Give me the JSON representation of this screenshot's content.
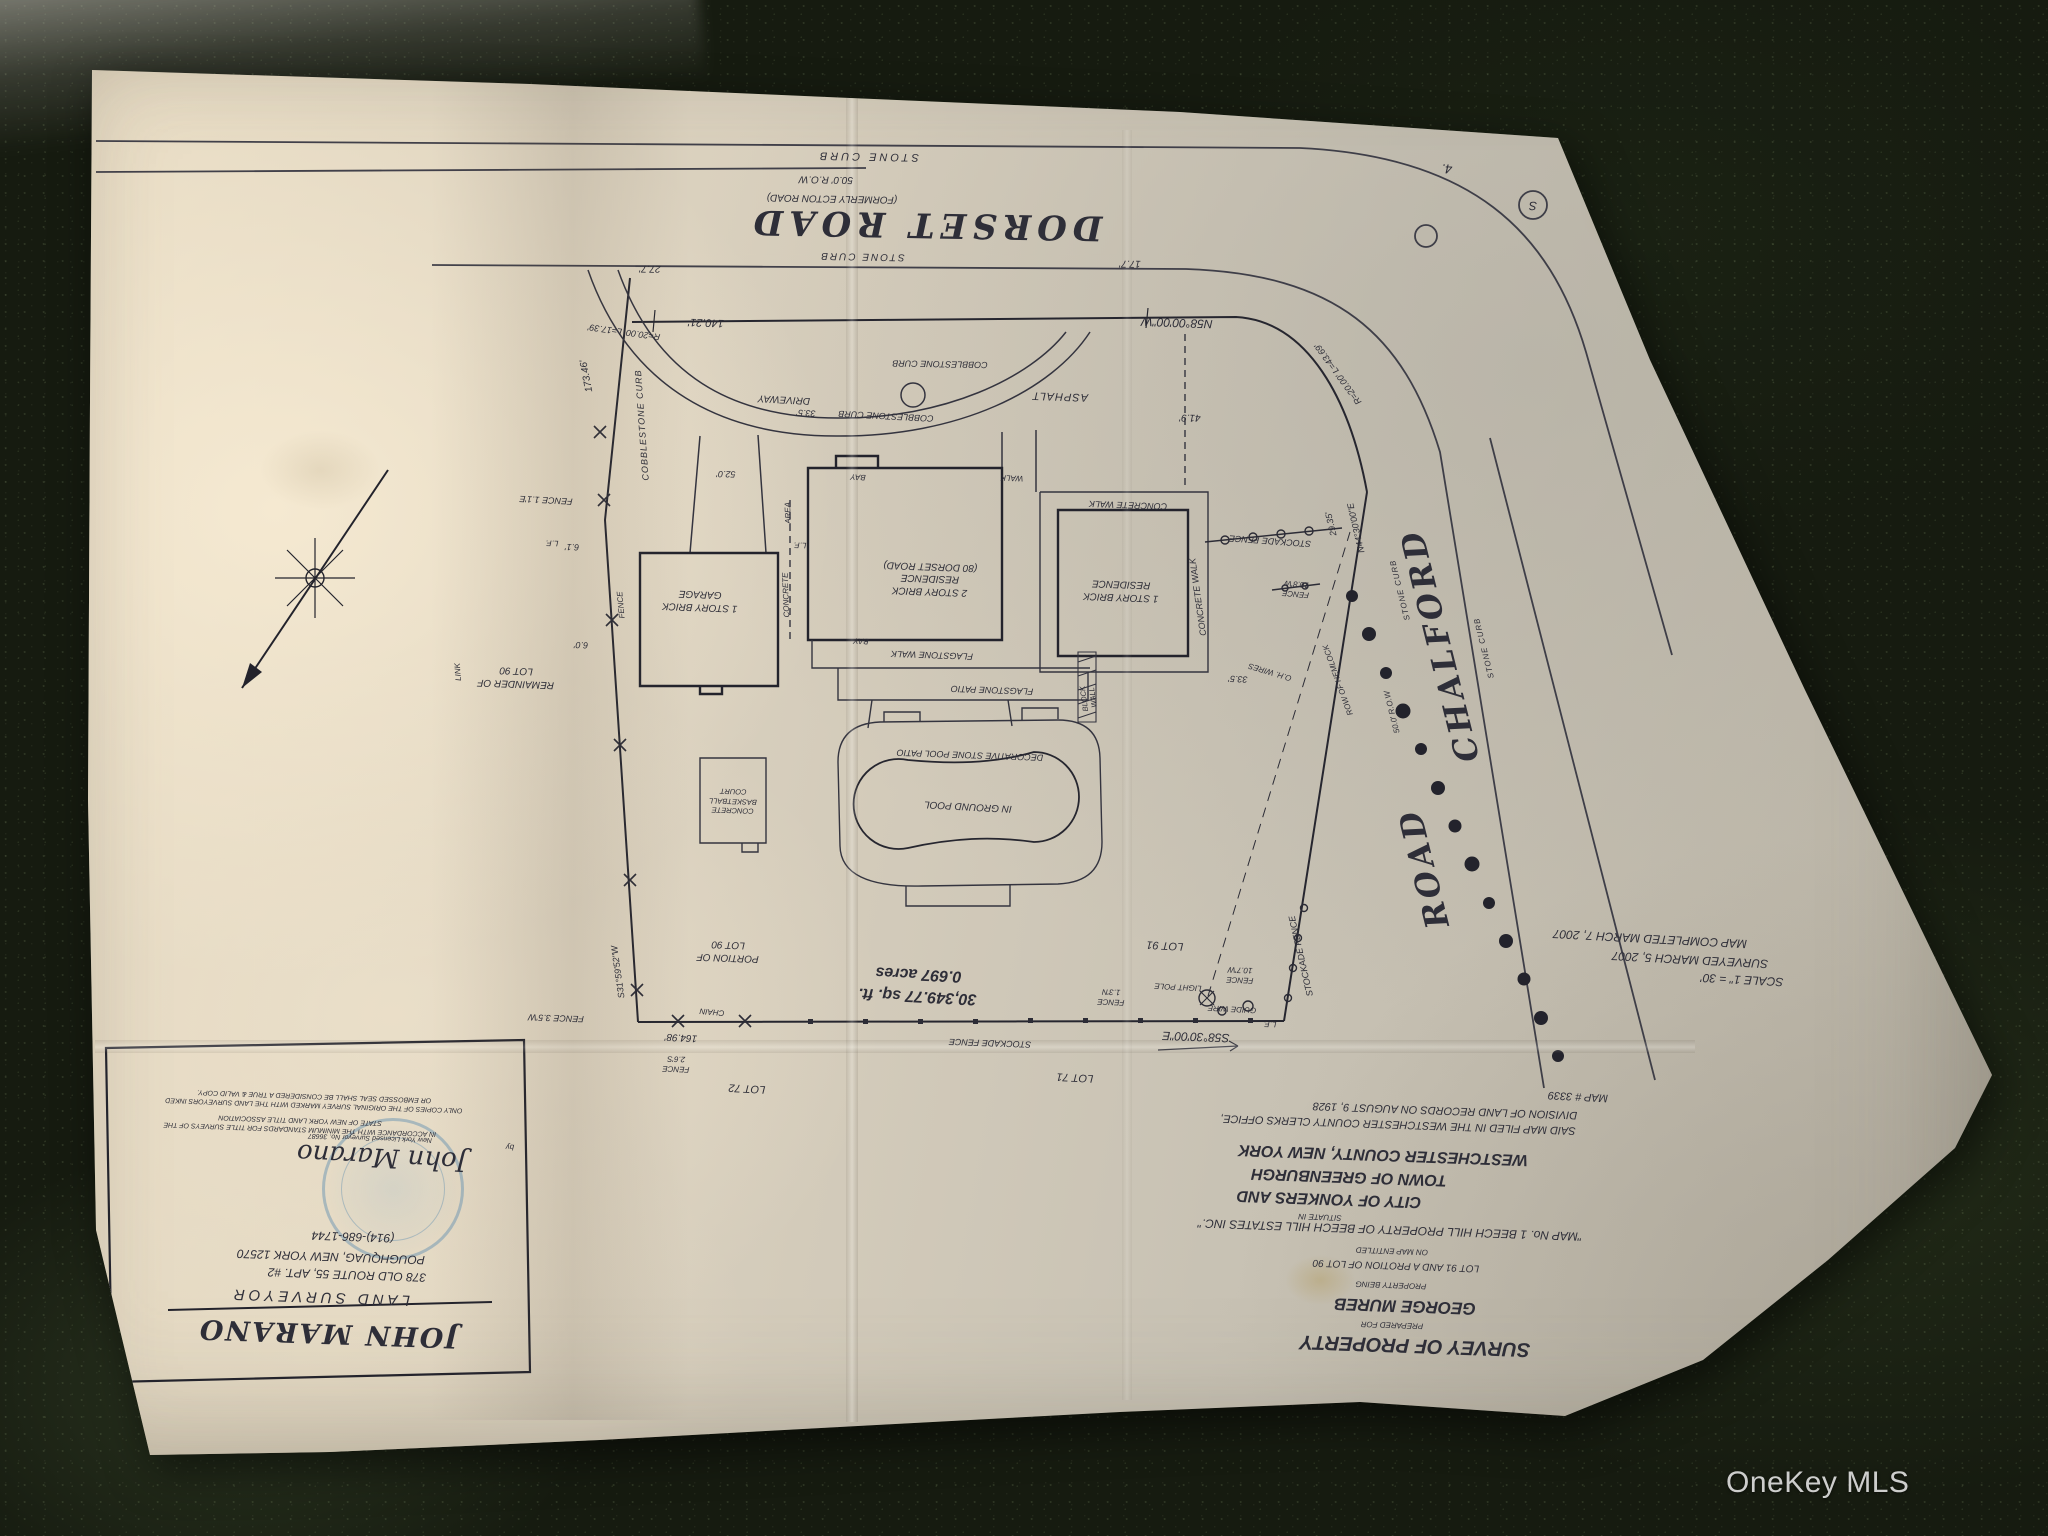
{
  "photo": {
    "watermark_label": "OneKey MLS",
    "subject": "upside-down paper land survey map photographed on dark granite countertop"
  },
  "colors": {
    "paper": "#d9d2c2",
    "ink": "#2e2e38",
    "seal_blue": "#6f9fbd",
    "countertop": "#161b10",
    "watermark": "#eeeeee"
  },
  "survey": {
    "labels": [
      {
        "t": "STONE CURB",
        "x": 868,
        "y": 156,
        "r": 181,
        "s": 11,
        "ls": 3
      },
      {
        "t": "50.0' R.O.W",
        "x": 826,
        "y": 179,
        "r": 181,
        "s": 10
      },
      {
        "t": "(FORMERLY ECTON ROAD)",
        "x": 832,
        "y": 198,
        "r": 181,
        "s": 10
      },
      {
        "n": "dorset-road-name",
        "t": "DORSET   ROAD",
        "x": 925,
        "y": 224,
        "r": 181,
        "s": 34,
        "f": "bi",
        "ser": 1,
        "ls": 6
      },
      {
        "t": "STONE CURB",
        "x": 862,
        "y": 256,
        "r": 181,
        "s": 10,
        "ls": 2
      },
      {
        "t": "17.7'",
        "x": 1130,
        "y": 263,
        "r": 181,
        "s": 10
      },
      {
        "t": "27.7'",
        "x": 650,
        "y": 268,
        "r": 181,
        "s": 10
      },
      {
        "t": "140.21'",
        "x": 706,
        "y": 322,
        "r": 182,
        "s": 11
      },
      {
        "t": "R=20.00' L=17.39'",
        "x": 624,
        "y": 332,
        "r": 188,
        "s": 9
      },
      {
        "n": "front-line-bearing",
        "t": "N58°00'00\"W",
        "x": 1177,
        "y": 322,
        "r": 182,
        "s": 12
      },
      {
        "t": "R=20.00' L=43.69'",
        "x": 1338,
        "y": 374,
        "r": 234,
        "s": 9
      },
      {
        "t": "41.9'",
        "x": 1190,
        "y": 417,
        "r": 181,
        "s": 10
      },
      {
        "t": "ASPHALT",
        "x": 1060,
        "y": 396,
        "r": 182,
        "s": 11,
        "ls": 1
      },
      {
        "t": "COBBLESTONE CURB",
        "x": 940,
        "y": 364,
        "r": 181,
        "s": 9
      },
      {
        "t": "COBBLESTONE CURB",
        "x": 886,
        "y": 416,
        "r": 183,
        "s": 9
      },
      {
        "t": "COBBLESTONE CURB",
        "x": 642,
        "y": 425,
        "r": 266,
        "s": 9,
        "ls": 1
      },
      {
        "t": "DRIVEWAY",
        "x": 784,
        "y": 399,
        "r": 183,
        "s": 10
      },
      {
        "t": "33.5'",
        "x": 806,
        "y": 413,
        "r": 183,
        "s": 9
      },
      {
        "t": "52.0'",
        "x": 726,
        "y": 474,
        "r": 181,
        "s": 9
      },
      {
        "t": "BAY",
        "x": 858,
        "y": 477,
        "r": 183,
        "s": 8
      },
      {
        "t": "WALK",
        "x": 1012,
        "y": 478,
        "r": 182,
        "s": 8
      },
      {
        "t": "CONCRETE WALK",
        "x": 1128,
        "y": 505,
        "r": 182,
        "s": 9
      },
      {
        "t": "CONCRETE WALK",
        "x": 1198,
        "y": 597,
        "r": 262,
        "s": 9
      },
      {
        "n": "one-story-residence-label",
        "t": "1 STORY BRICK\nRESIDENCE",
        "x": 1121,
        "y": 590,
        "r": 182,
        "s": 10,
        "lh": 1.25
      },
      {
        "n": "two-story-residence-label",
        "t": "2 STORY BRICK\nRESIDENCE\n(80 DORSET ROAD)",
        "x": 930,
        "y": 578,
        "r": 182,
        "s": 10,
        "lh": 1.25
      },
      {
        "n": "garage-label",
        "t": "1 STORY BRICK\nGARAGE",
        "x": 700,
        "y": 600,
        "r": 182,
        "s": 10,
        "lh": 1.25
      },
      {
        "t": "CONCRETE",
        "x": 786,
        "y": 595,
        "r": 268,
        "s": 8
      },
      {
        "t": "AREA",
        "x": 788,
        "y": 513,
        "r": 268,
        "s": 8
      },
      {
        "t": "L.F.",
        "x": 800,
        "y": 545,
        "r": 182,
        "s": 8
      },
      {
        "t": "L.F.",
        "x": 552,
        "y": 543,
        "r": 182,
        "s": 8
      },
      {
        "t": "L.F.",
        "x": 1270,
        "y": 1024,
        "r": 182,
        "s": 8
      },
      {
        "t": "FENCE 1.1'E",
        "x": 546,
        "y": 500,
        "r": 183,
        "s": 9
      },
      {
        "t": "6.1'",
        "x": 572,
        "y": 547,
        "r": 182,
        "s": 9
      },
      {
        "t": "FENCE",
        "x": 621,
        "y": 605,
        "r": 265,
        "s": 8
      },
      {
        "t": "6.0'",
        "x": 581,
        "y": 645,
        "r": 182,
        "s": 9
      },
      {
        "t": "REMAINDER OF\nLOT 90",
        "x": 516,
        "y": 677,
        "r": 182,
        "s": 10,
        "lh": 1.3
      },
      {
        "t": "PORTION OF\nLOT 90",
        "x": 728,
        "y": 951,
        "r": 182,
        "s": 10,
        "lh": 1.3
      },
      {
        "t": "LINK",
        "x": 458,
        "y": 672,
        "r": 266,
        "s": 8
      },
      {
        "t": "CHAIN",
        "x": 712,
        "y": 1012,
        "r": 185,
        "s": 8
      },
      {
        "t": "164.98'",
        "x": 681,
        "y": 1037,
        "r": 183,
        "s": 10
      },
      {
        "t": "FENCE\n2.6'S",
        "x": 676,
        "y": 1064,
        "r": 182,
        "s": 8,
        "lh": 1.2
      },
      {
        "t": "LOT 72",
        "x": 747,
        "y": 1088,
        "r": 183,
        "s": 11
      },
      {
        "t": "LOT 71",
        "x": 1075,
        "y": 1077,
        "r": 183,
        "s": 11
      },
      {
        "t": "LOT 91",
        "x": 1165,
        "y": 945,
        "r": 183,
        "s": 11
      },
      {
        "t": "S31°59'52\"W",
        "x": 618,
        "y": 972,
        "r": 262,
        "s": 9
      },
      {
        "t": "FENCE 3.5'W",
        "x": 556,
        "y": 1018,
        "r": 182,
        "s": 9
      },
      {
        "t": "173.46'",
        "x": 587,
        "y": 376,
        "r": 259,
        "s": 10
      },
      {
        "n": "south-line-bearing",
        "t": "S58°30'00\"E",
        "x": 1196,
        "y": 1036,
        "r": 182,
        "s": 12
      },
      {
        "t": "STOCKADE FENCE",
        "x": 990,
        "y": 1043,
        "r": 182,
        "s": 9
      },
      {
        "t": "STOCKADE FENCE",
        "x": 1270,
        "y": 541,
        "r": 184,
        "s": 9
      },
      {
        "t": "STOCKADE FENCE",
        "x": 1301,
        "y": 956,
        "r": 257,
        "s": 9
      },
      {
        "t": "FENCE\n10.7'W",
        "x": 1240,
        "y": 975,
        "r": 182,
        "s": 8,
        "lh": 1.2
      },
      {
        "t": "LIGHT POLE",
        "x": 1178,
        "y": 987,
        "r": 183,
        "s": 8
      },
      {
        "t": "FENCE\n1.3'N",
        "x": 1111,
        "y": 997,
        "r": 182,
        "s": 8,
        "lh": 1.2
      },
      {
        "t": "GUIDE WIRE",
        "x": 1232,
        "y": 1009,
        "r": 183,
        "s": 8
      },
      {
        "t": "FENCE\n10.8'W",
        "x": 1296,
        "y": 589,
        "r": 185,
        "s": 8,
        "lh": 1.2
      },
      {
        "t": "O.H. WIRES",
        "x": 1270,
        "y": 672,
        "r": 197,
        "s": 8
      },
      {
        "t": "33.5'",
        "x": 1238,
        "y": 679,
        "r": 183,
        "s": 9
      },
      {
        "n": "east-line-bearing",
        "t": "N44°30'00\"E",
        "x": 1356,
        "y": 528,
        "r": 257,
        "s": 9
      },
      {
        "t": "29.35'",
        "x": 1331,
        "y": 524,
        "r": 257,
        "s": 9
      },
      {
        "t": "ROW OF HEMLOCK",
        "x": 1338,
        "y": 680,
        "r": 250,
        "s": 8
      },
      {
        "t": "STONE CURB",
        "x": 1400,
        "y": 590,
        "r": 256,
        "s": 8,
        "ls": 1
      },
      {
        "t": "STONE CURB",
        "x": 1484,
        "y": 648,
        "r": 256,
        "s": 8,
        "ls": 1
      },
      {
        "t": "50.0' R.O.W",
        "x": 1392,
        "y": 712,
        "r": 256,
        "s": 8
      },
      {
        "n": "chalford-road-name-1",
        "t": "CHALFORD",
        "x": 1440,
        "y": 645,
        "r": 256,
        "s": 32,
        "f": "bi",
        "ser": 1,
        "ls": 4
      },
      {
        "n": "chalford-road-name-2",
        "t": "ROAD",
        "x": 1424,
        "y": 868,
        "r": 256,
        "s": 32,
        "f": "bi",
        "ser": 1,
        "ls": 4
      },
      {
        "n": "lot-area",
        "t": "30,349.77 sq. ft.\n0.697 acres",
        "x": 918,
        "y": 985,
        "r": 183,
        "s": 16,
        "f": "b",
        "lh": 1.35
      },
      {
        "t": "MAP COMPLETED MARCH 7, 2007",
        "x": 1650,
        "y": 938,
        "r": 183,
        "s": 12
      },
      {
        "t": "SURVEYED MARCH 5, 2007",
        "x": 1690,
        "y": 959,
        "r": 183,
        "s": 12
      },
      {
        "n": "scale-note",
        "t": "SCALE 1\" = 30'",
        "x": 1742,
        "y": 979,
        "r": 183,
        "s": 12
      },
      {
        "t": "MAP # 3339",
        "x": 1578,
        "y": 1096,
        "r": 183,
        "s": 11
      },
      {
        "t": "DIVISION OF LAND RECORDS ON AUGUST 9, 1928",
        "x": 1445,
        "y": 1110,
        "r": 182,
        "s": 11
      },
      {
        "t": "SAID MAP FILED IN THE WESTCHESTER COUNTY CLERKS OFFICE,",
        "x": 1398,
        "y": 1124,
        "r": 182,
        "s": 11
      },
      {
        "t": "WESTCHESTER COUNTY, NEW YORK",
        "x": 1383,
        "y": 1154,
        "r": 182,
        "s": 16,
        "f": "bi"
      },
      {
        "t": "TOWN OF GREENBURGH",
        "x": 1349,
        "y": 1176,
        "r": 182,
        "s": 16,
        "f": "bi"
      },
      {
        "t": "CITY OF YONKERS AND",
        "x": 1329,
        "y": 1198,
        "r": 182,
        "s": 16,
        "f": "bi"
      },
      {
        "t": "SITUATE IN",
        "x": 1320,
        "y": 1217,
        "r": 182,
        "s": 8
      },
      {
        "t": "\"MAP No. 1 BEECH HILL PROPERTY OF BEECH HILL ESTATES INC.\"",
        "x": 1390,
        "y": 1229,
        "r": 182,
        "s": 12
      },
      {
        "t": "ON MAP ENTITLED",
        "x": 1392,
        "y": 1251,
        "r": 182,
        "s": 8
      },
      {
        "t": "LOT 91 AND A PROTION OF LOT 90",
        "x": 1396,
        "y": 1265,
        "r": 182,
        "s": 10
      },
      {
        "t": "PROPERTY BEING",
        "x": 1391,
        "y": 1285,
        "r": 182,
        "s": 8
      },
      {
        "n": "client-name",
        "t": "GEORGE MUREB",
        "x": 1405,
        "y": 1306,
        "r": 182,
        "s": 17,
        "f": "bi"
      },
      {
        "t": "PREPARED FOR",
        "x": 1392,
        "y": 1325,
        "r": 182,
        "s": 8
      },
      {
        "n": "survey-title",
        "t": "SURVEY OF PROPERTY",
        "x": 1415,
        "y": 1345,
        "r": 182,
        "s": 20,
        "f": "bi"
      },
      {
        "n": "surveyor-name",
        "t": "JOHN MARANO",
        "x": 328,
        "y": 1333,
        "r": 182,
        "s": 27,
        "f": "bi",
        "ser": 1,
        "ls": 2
      },
      {
        "t": "LAND SURVEYOR",
        "x": 320,
        "y": 1297,
        "r": 182,
        "s": 15,
        "ls": 4
      },
      {
        "t": "378 OLD ROUTE 55, APT. #2",
        "x": 347,
        "y": 1274,
        "r": 182,
        "s": 12
      },
      {
        "t": "POUGHQUAG, NEW YORK 12570",
        "x": 331,
        "y": 1256,
        "r": 182,
        "s": 12
      },
      {
        "t": "(914)-686-1744",
        "x": 353,
        "y": 1236,
        "r": 182,
        "s": 12
      },
      {
        "t": "ONLY COPIES OF THE ORIGINAL SURVEY MARKED WITH THE LAND SURVEYORS INKED\nOR EMBOSSED SEAL SHALL BE CONSIDERED A TRUE & VALID COPY.",
        "x": 314,
        "y": 1100,
        "r": 182,
        "s": 7,
        "lh": 1.35
      },
      {
        "t": "IN ACCORDANCE WITH THE MINIMUM STANDARDS FOR TITLE SURVEYS OF THE\nSTATE OF NEW YORK LAND TITLE ASSOCIATION",
        "x": 300,
        "y": 1124,
        "r": 182,
        "s": 7,
        "lh": 1.35
      },
      {
        "t": "by",
        "x": 510,
        "y": 1147,
        "r": 182,
        "s": 8
      },
      {
        "n": "surveyor-signature",
        "t": "John Marano",
        "x": 382,
        "y": 1156,
        "r": 183,
        "s": 26,
        "f": "i",
        "ser": 1
      },
      {
        "t": "New York Licensed Surveyor No. 36687",
        "x": 370,
        "y": 1137,
        "r": 182,
        "s": 7
      },
      {
        "t": "4.",
        "x": 1447,
        "y": 168,
        "r": 182,
        "s": 13
      },
      {
        "t": "S",
        "x": 1533,
        "y": 205,
        "r": 182,
        "s": 12
      },
      {
        "t": "FLAGSTONE WALK",
        "x": 932,
        "y": 655,
        "r": 182,
        "s": 9
      },
      {
        "t": "FLAGSTONE PATIO",
        "x": 992,
        "y": 690,
        "r": 182,
        "s": 9
      },
      {
        "t": "DECORATIVE STONE POOL PATIO",
        "x": 970,
        "y": 755,
        "r": 182,
        "s": 9
      },
      {
        "n": "pool-label",
        "t": "IN GROUND POOL",
        "x": 968,
        "y": 806,
        "r": 183,
        "s": 10
      },
      {
        "t": "CONCRETE\nBASKETBALL\nCOURT",
        "x": 733,
        "y": 801,
        "r": 182,
        "s": 7.5,
        "lh": 1.25
      },
      {
        "t": "BLOCK\nWALL",
        "x": 1089,
        "y": 698,
        "r": 262,
        "s": 7.5,
        "lh": 1.15
      },
      {
        "t": "BAY",
        "x": 861,
        "y": 641,
        "r": 183,
        "s": 8
      }
    ]
  }
}
